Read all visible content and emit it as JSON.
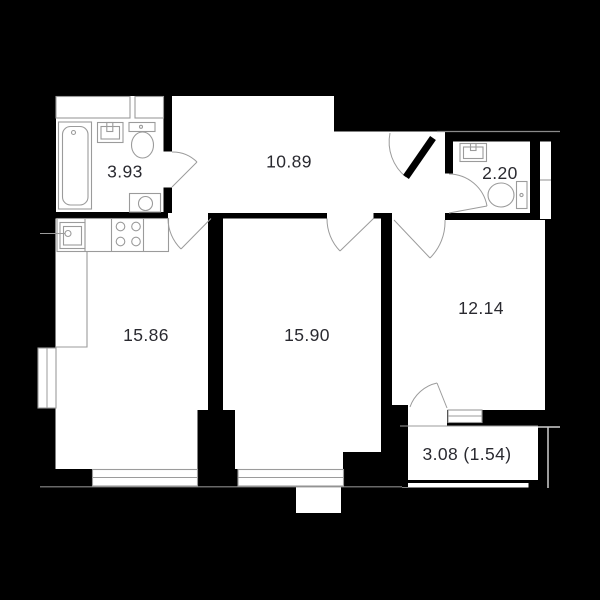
{
  "plan": {
    "title": "apartment-floor-plan",
    "rooms": {
      "bathroom": {
        "area_label": "3.93"
      },
      "hallway": {
        "area_label": "10.89"
      },
      "wc": {
        "area_label": "2.20"
      },
      "kitchen_living": {
        "area_label": "15.86"
      },
      "bedroom": {
        "area_label": "15.90"
      },
      "room": {
        "area_label": "12.14"
      },
      "balcony": {
        "area_label": "3.08 (1.54)"
      }
    },
    "fixtures": [
      "bathtub",
      "bath-sink",
      "bath-toilet",
      "washing-machine",
      "kitchen-sink",
      "stove",
      "kitchen-counter",
      "wc-sink",
      "wc-toilet",
      "ventilation-shaft"
    ],
    "openings": [
      "entrance-door",
      "bathroom-door",
      "wc-door",
      "kitchen-door",
      "bedroom-door",
      "room-door",
      "balcony-door",
      "kitchen-window",
      "bedroom-window",
      "side-window",
      "balcony-fixed-window"
    ],
    "colors": {
      "background": "#000000",
      "room_fill": "#ffffff",
      "fixture_stroke": "#9b9b9b",
      "outline_stroke": "#8a8a8a",
      "label_text": "#2a2a30"
    }
  }
}
